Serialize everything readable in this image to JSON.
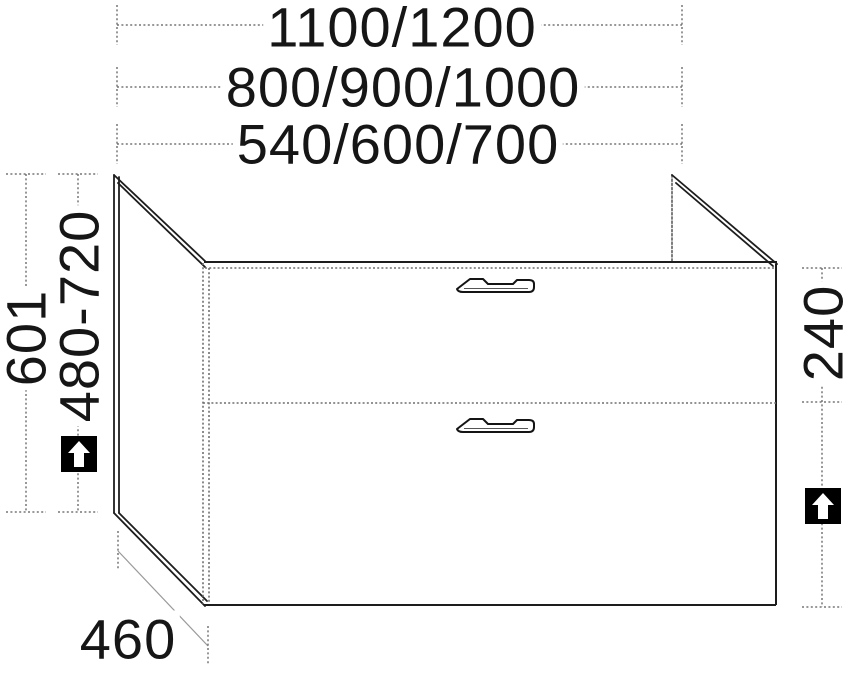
{
  "drawing": {
    "subject": "Two-drawer vanity cabinet technical line drawing",
    "dimensions": {
      "top": [
        {
          "id": "width-row-1",
          "label": "1100/1200"
        },
        {
          "id": "width-row-2",
          "label": "800/900/1000"
        },
        {
          "id": "width-row-3",
          "label": "540/600/700"
        }
      ],
      "left": [
        {
          "id": "carcase-height",
          "label": "601"
        },
        {
          "id": "adjustable-height-range",
          "label": "480-720",
          "icon": "up-arrow-square"
        }
      ],
      "right": [
        {
          "id": "top-drawer-height",
          "label": "240"
        },
        {
          "id": "bottom-drawer-zone",
          "label": "",
          "icon": "up-arrow-square"
        }
      ],
      "bottom": [
        {
          "id": "depth",
          "label": "460"
        }
      ]
    },
    "symbols": {
      "height_adjustable_icon": "up-arrow in black square"
    },
    "colors": {
      "background": "#ffffff",
      "solid_line": "#1d1d1d",
      "dashed_dimension_line": "#767676",
      "dotted_edge_line": "#6f6f6f",
      "text": "#161616",
      "icon_background": "#000000",
      "icon_arrow": "#ffffff"
    }
  }
}
